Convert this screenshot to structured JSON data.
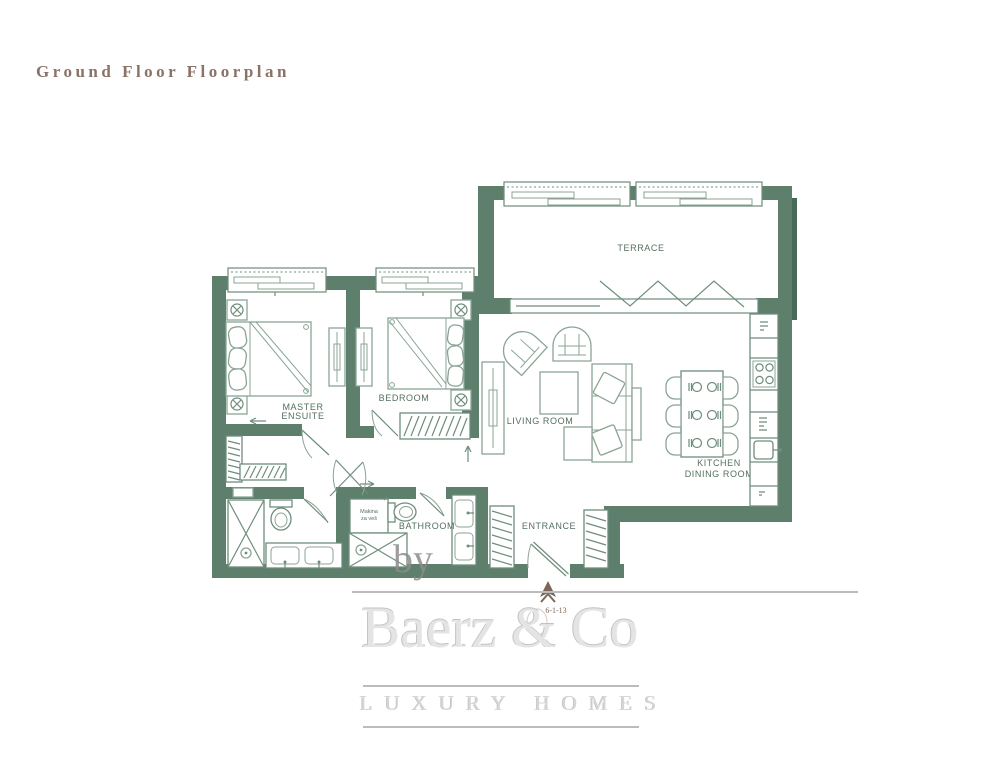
{
  "title": "Ground Floor Floorplan",
  "colors": {
    "wall": "#5d7f6b",
    "wall_shadow": "#4a6a58",
    "furniture": "#8aa496",
    "furniture_dark": "#6f8d7c",
    "label": "#54705f",
    "title": "#8a7266",
    "watermark": "#e4e4e4",
    "watermark_line": "#bcbcbc",
    "north": "#7d675a"
  },
  "rooms": {
    "terrace": "TERRACE",
    "master_ensuite": [
      "MASTER",
      "ENSUITE"
    ],
    "bedroom": "BEDROOM",
    "living_room": "LIVING ROOM",
    "bathroom": "BATHROOM",
    "entrance": "ENTRANCE",
    "kitchen_dining": [
      "KITCHEN",
      "DINING ROOM"
    ]
  },
  "annotations": {
    "appliance": [
      "Makina",
      "za veš"
    ],
    "north_mark": "6-1-13"
  },
  "watermark": {
    "prefix": "by",
    "brand": "Baerz & Co",
    "tagline": "LUXURY HOMES"
  }
}
